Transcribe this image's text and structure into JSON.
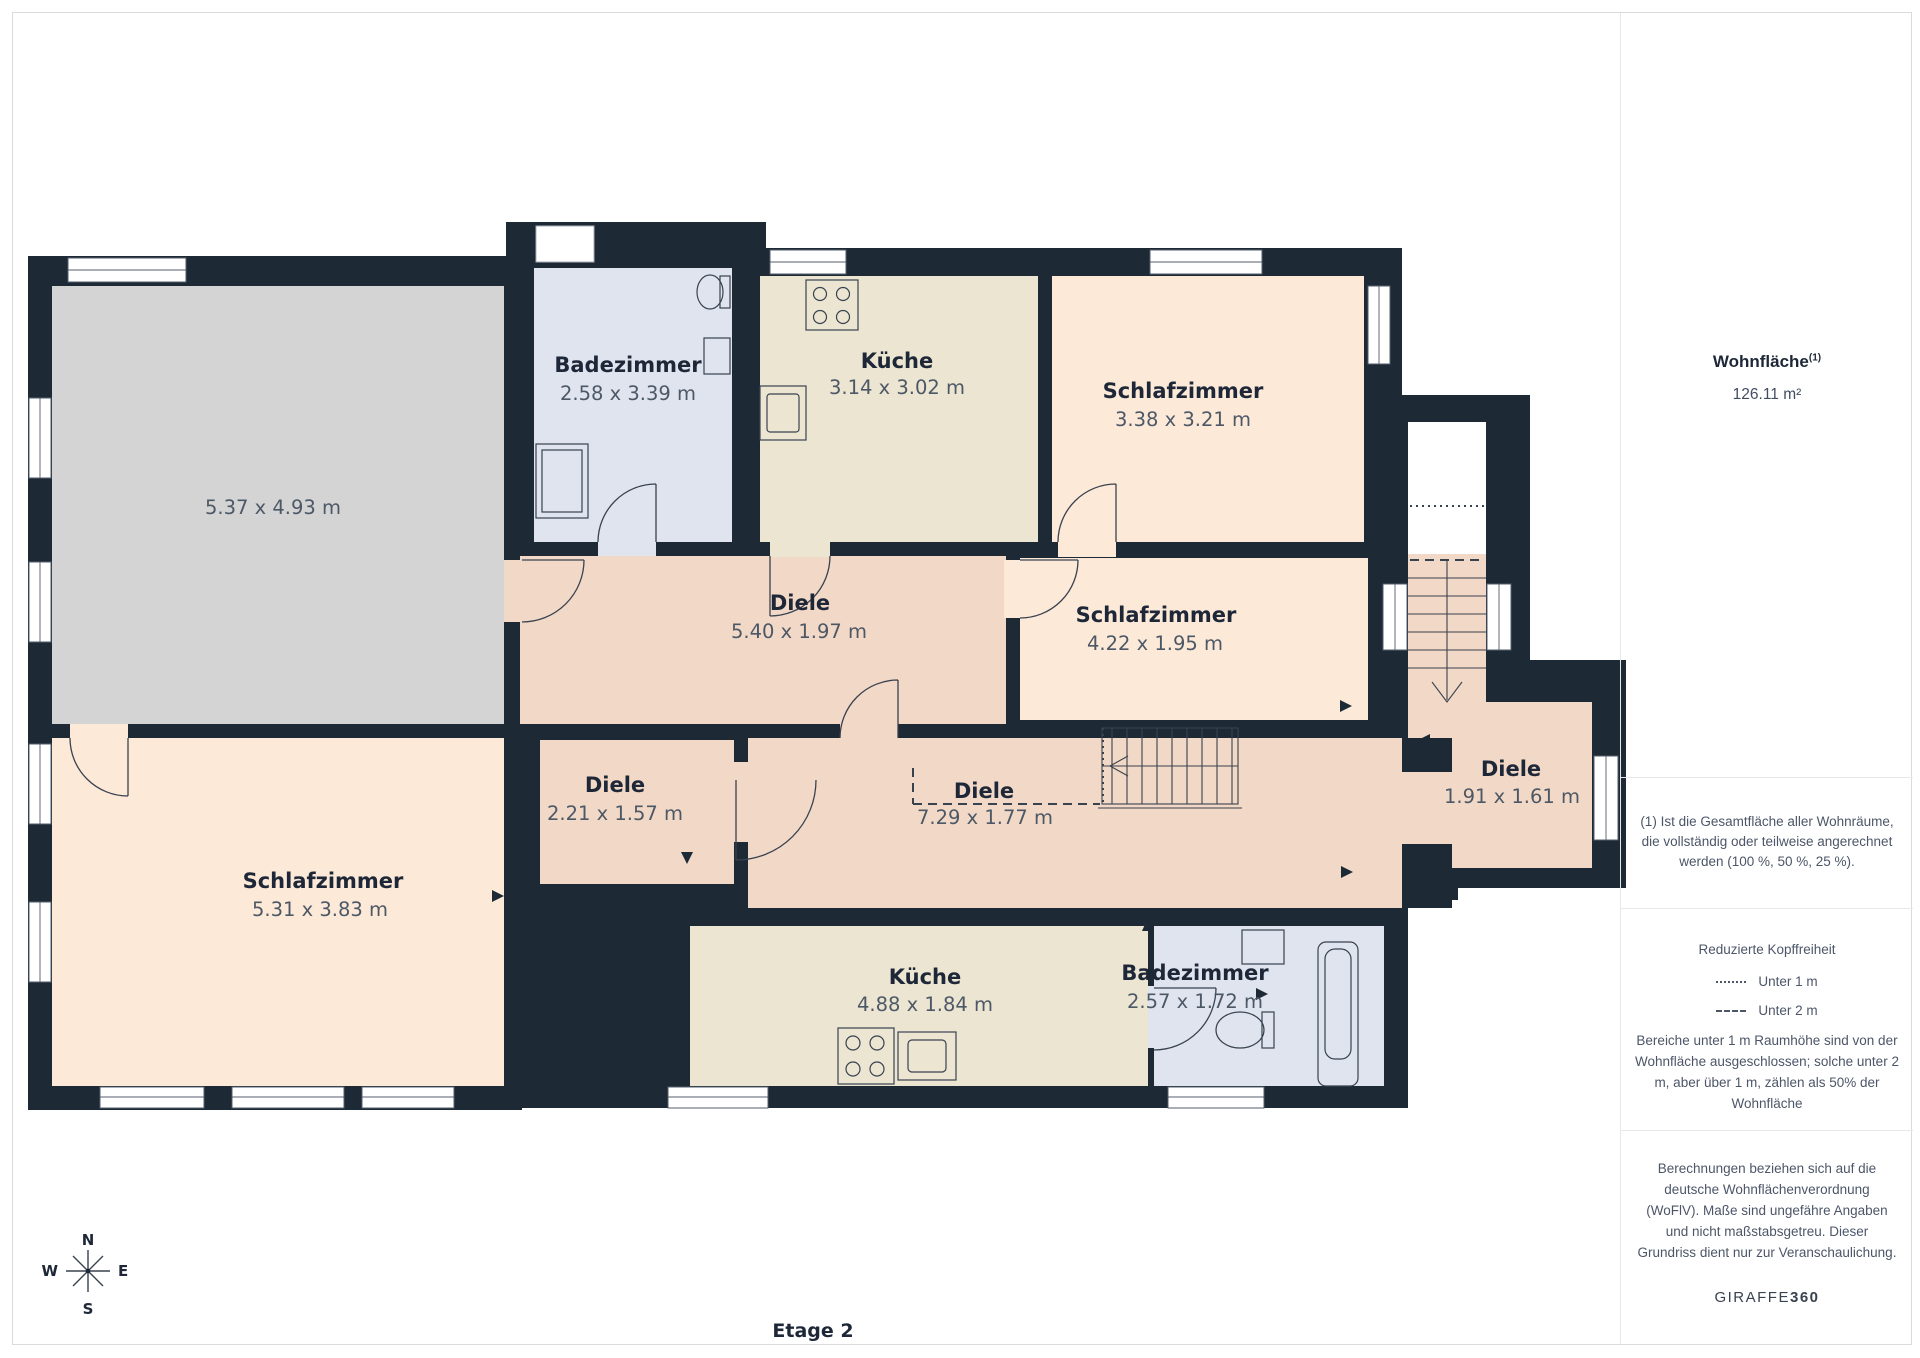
{
  "page": {
    "floor_label": "Etage 2"
  },
  "plan": {
    "rooms": [
      {
        "name": "",
        "dims": "5.37 x 4.93 m"
      },
      {
        "name": "Badezimmer",
        "dims": "2.58 x 3.39 m"
      },
      {
        "name": "Küche",
        "dims": "3.14 x 3.02 m"
      },
      {
        "name": "Schlafzimmer",
        "dims": "3.38 x 3.21 m"
      },
      {
        "name": "Diele",
        "dims": "5.40 x 1.97 m"
      },
      {
        "name": "Schlafzimmer",
        "dims": "4.22 x 1.95 m"
      },
      {
        "name": "Diele",
        "dims": "2.21 x 1.57 m"
      },
      {
        "name": "Diele",
        "dims": "7.29 x 1.77 m"
      },
      {
        "name": "Diele",
        "dims": "1.91 x 1.61 m"
      },
      {
        "name": "Schlafzimmer",
        "dims": "5.31 x 3.83 m"
      },
      {
        "name": "Küche",
        "dims": "4.88 x 1.84 m"
      },
      {
        "name": "Badezimmer",
        "dims": "2.57 x 1.72 m"
      }
    ],
    "compass": {
      "n": "N",
      "e": "E",
      "s": "S",
      "w": "W"
    }
  },
  "sidebar": {
    "area_title": "Wohnfläche",
    "area_footnote_marker": "(1)",
    "area_value": "126.11 m²",
    "footnote": "(1) Ist die Gesamtfläche aller Wohnräume, die vollständig oder teilweise angerechnet werden (100 %, 50 %, 25 %).",
    "headroom": {
      "title": "Reduzierte Kopffreiheit",
      "legend": [
        {
          "style": "dotted",
          "label": "Unter 1 m"
        },
        {
          "style": "dashed",
          "label": "Unter 2 m"
        }
      ],
      "note": "Bereiche unter 1 m Raumhöhe sind von der Wohnfläche ausgeschlossen; solche unter 2 m, aber über 1 m, zählen als 50% der Wohnfläche"
    },
    "disclaimer": "Berechnungen beziehen sich auf die deutsche Wohnflächenverordnung (WoFlV). Maße sind ungefähre Angaben und nicht maßstabsgetreu. Dieser Grundriss dient nur zur Veranschaulichung.",
    "brand": {
      "name": "GIRAFFE",
      "suffix": "360"
    }
  },
  "colors": {
    "wall": "#1e2936",
    "bedroom": "#fce9d8",
    "kitchen": "#ebe5d2",
    "bathroom": "#dfe4ef",
    "hallway": "#f2d8c6",
    "unnamed_room": "#d4d4d5",
    "text_dark": "#1d2737",
    "text_muted": "#4c5668"
  }
}
